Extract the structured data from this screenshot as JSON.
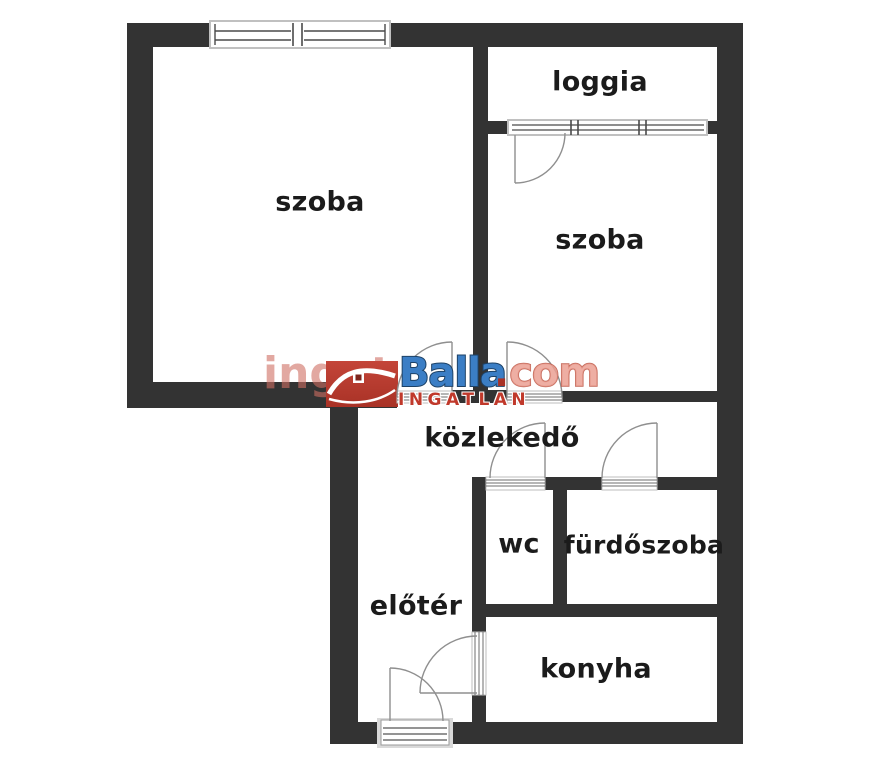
{
  "rooms": [
    {
      "id": "szoba-1",
      "label": "szoba"
    },
    {
      "id": "loggia",
      "label": "loggia"
    },
    {
      "id": "szoba-2",
      "label": "szoba"
    },
    {
      "id": "kozlekedo",
      "label": "közlekedő"
    },
    {
      "id": "wc",
      "label": "wc"
    },
    {
      "id": "furdoszoba",
      "label": "fürdőszoba"
    },
    {
      "id": "eloter",
      "label": "előtér"
    },
    {
      "id": "konyha",
      "label": "konyha"
    }
  ],
  "watermark": {
    "prefix": "ingat",
    "brand": "Balla",
    "dot": ".",
    "suffix": "com",
    "subtitle": "INGATLAN"
  },
  "colors": {
    "wall": "#333333",
    "brand_blue": "#3b7ec5",
    "brand_red": "#c0392b",
    "watermark_pink": "#cf6e62"
  }
}
